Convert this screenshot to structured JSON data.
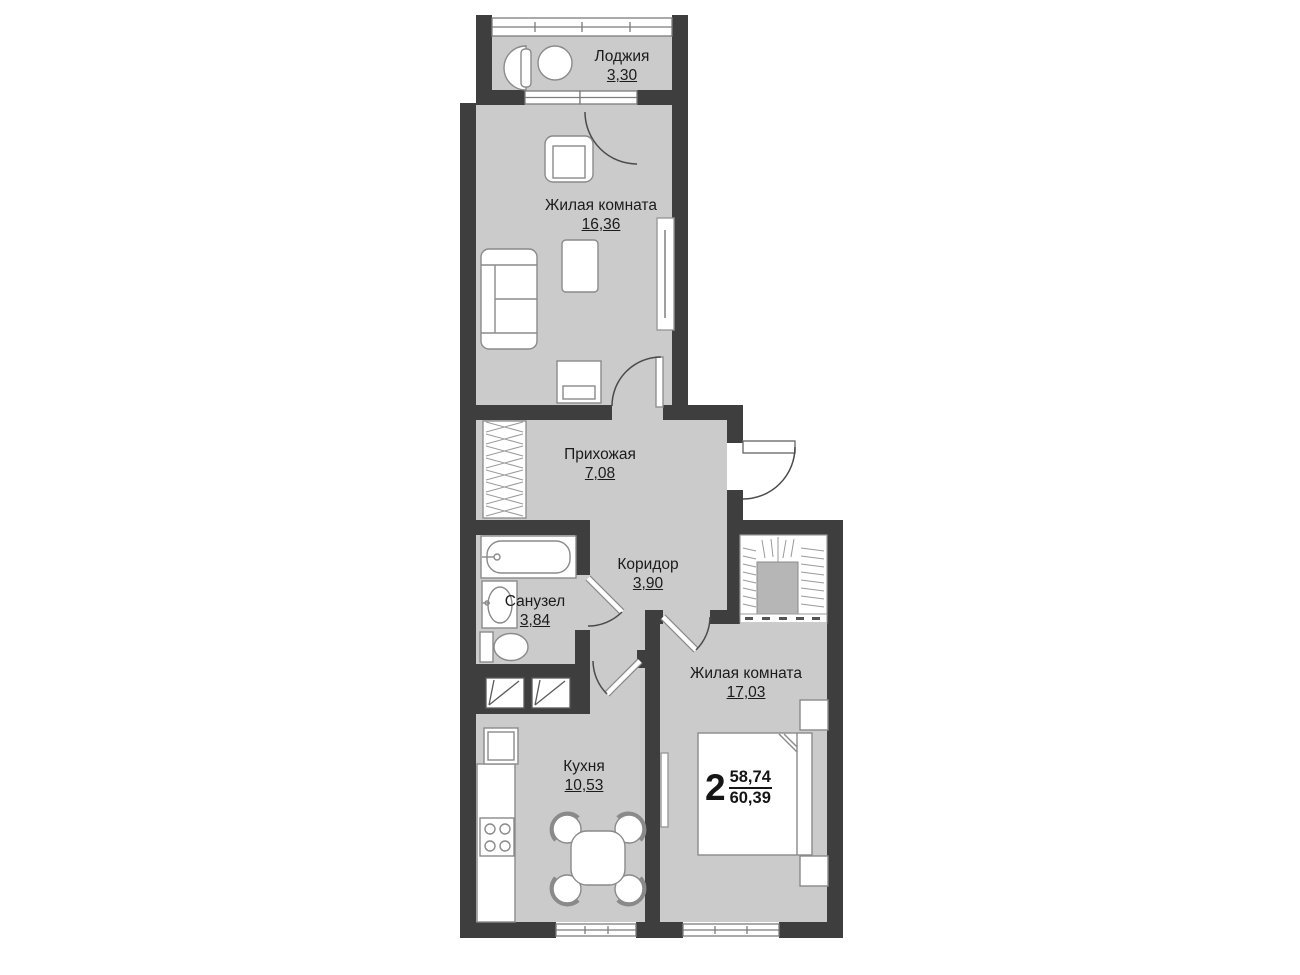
{
  "plan": {
    "rooms": [
      {
        "name": "Лоджия",
        "area": "3,30"
      },
      {
        "name": "Жилая комната",
        "area": "16,36"
      },
      {
        "name": "Прихожая",
        "area": "7,08"
      },
      {
        "name": "Коридор",
        "area": "3,90"
      },
      {
        "name": "Санузел",
        "area": "3,84"
      },
      {
        "name": "Жилая комната",
        "area": "17,03"
      },
      {
        "name": "Кухня",
        "area": "10,53"
      }
    ],
    "apartment": {
      "rooms_count": "2",
      "living_area": "58,74",
      "total_area": "60,39"
    },
    "colors": {
      "wall": "#3e3e3e",
      "floor": "#cbcbcb",
      "furniture": "#ffffff",
      "outline": "#8a8a8a",
      "text": "#1b1b1b"
    }
  }
}
